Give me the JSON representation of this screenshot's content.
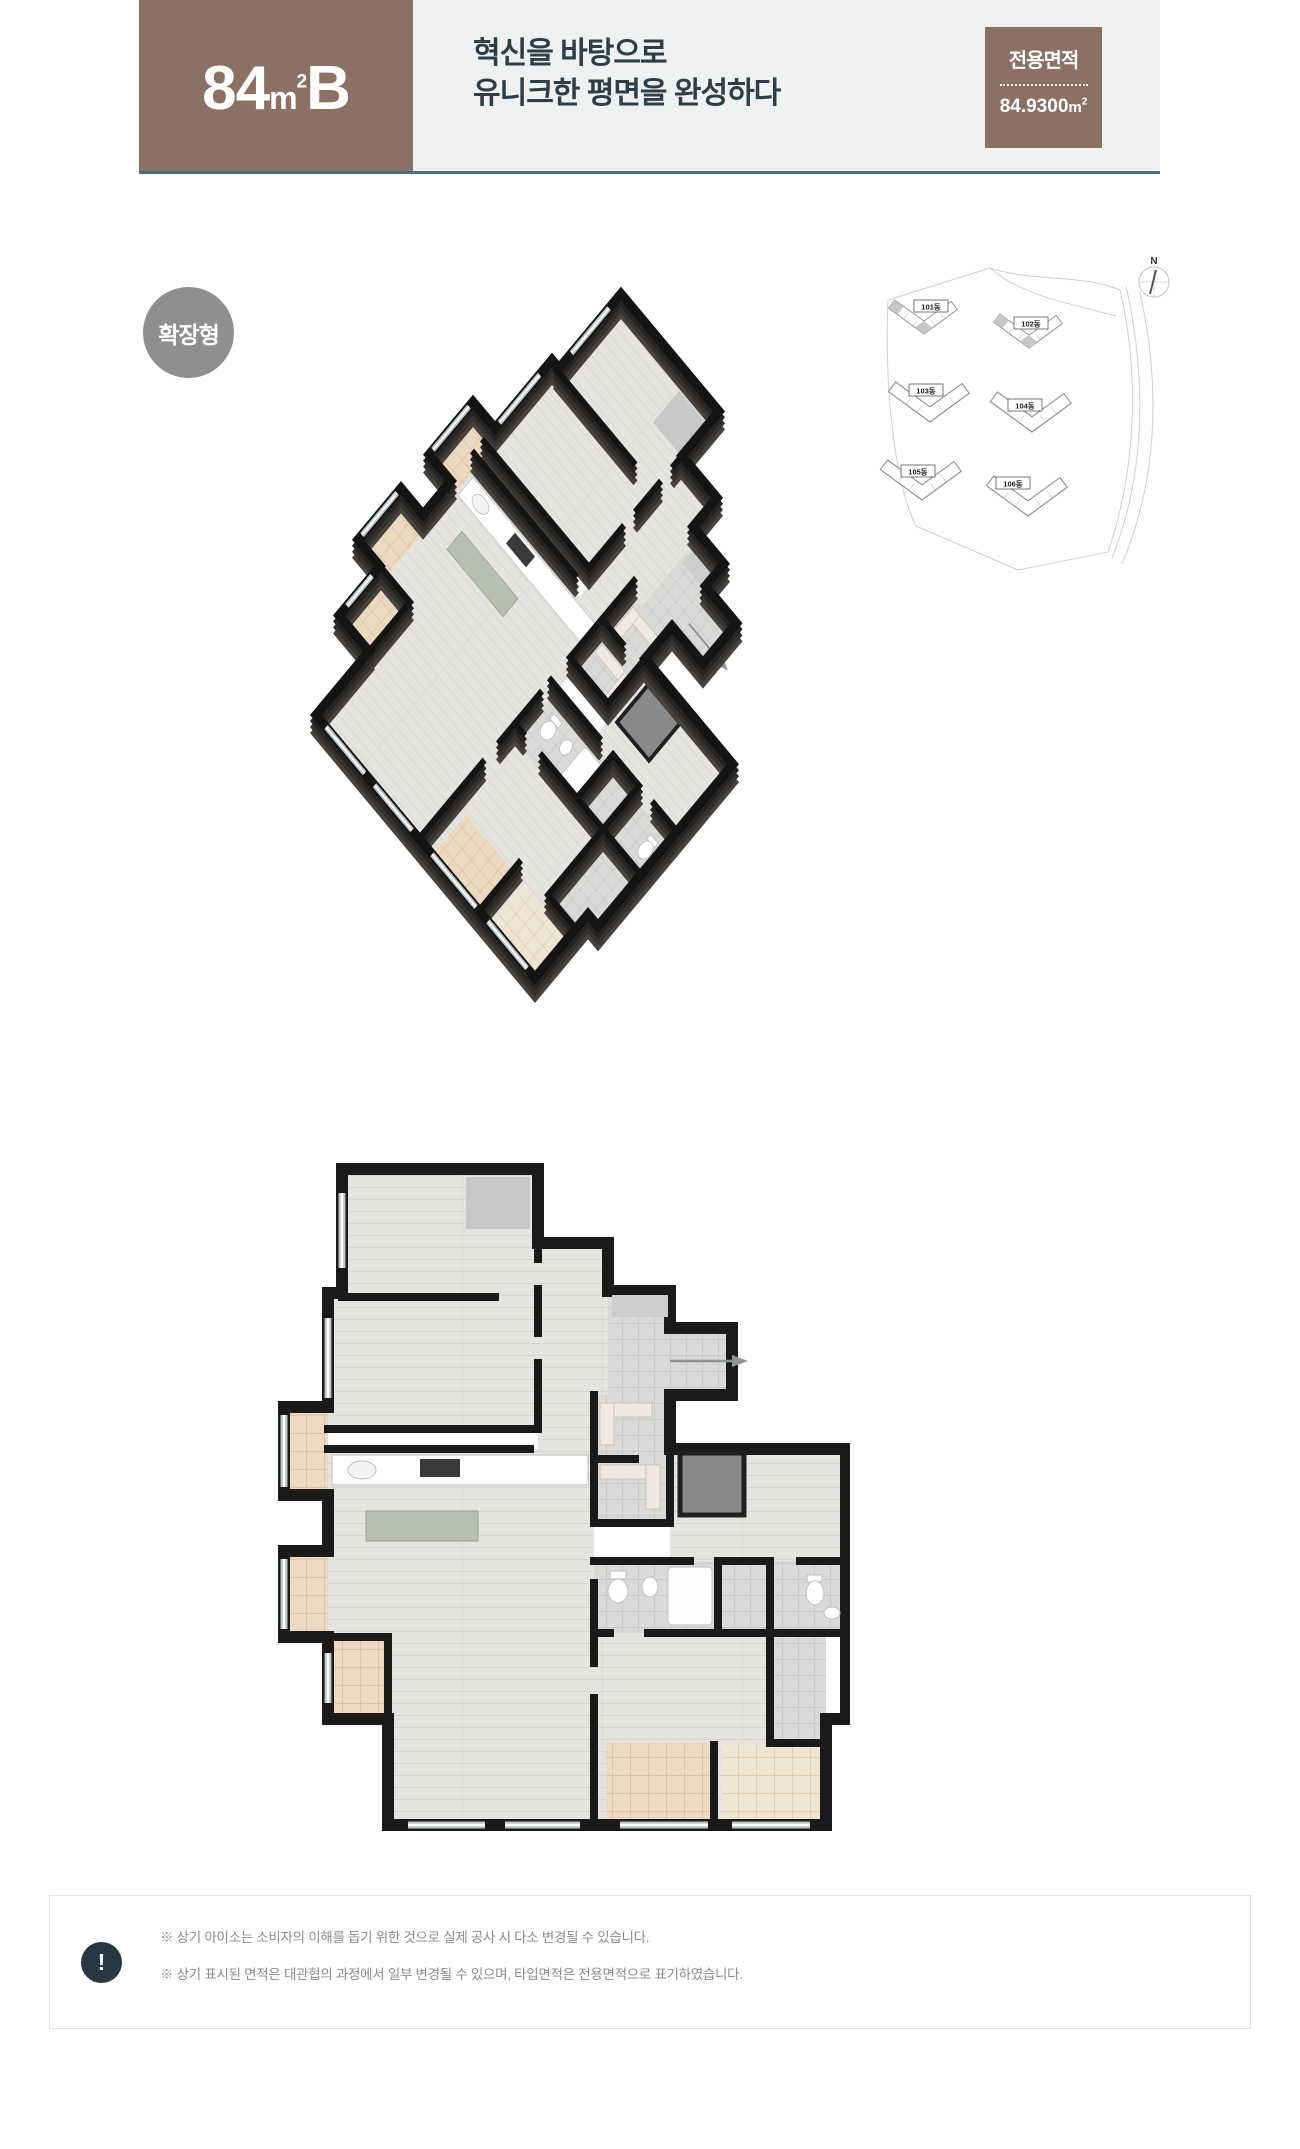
{
  "header": {
    "unit": {
      "num": "84",
      "m": "m",
      "sup": "2",
      "variant": "B"
    },
    "title_line1": "혁신을 바탕으로",
    "title_line2": "유니크한 평면을 완성하다",
    "area_box": {
      "label": "전용면적",
      "value": "84.9300",
      "unit_m": "m",
      "unit_sup": "2"
    },
    "colors": {
      "brown": "#8a7164",
      "band_bg": "#f0f1f1",
      "title_text": "#2d3e49",
      "underline": "#4a6d80"
    }
  },
  "badge": {
    "label": "확장형",
    "color": "#8f8f90"
  },
  "site_plan": {
    "compass_label": "N",
    "buildings": [
      {
        "name": "101동",
        "highlighted": true
      },
      {
        "name": "102동",
        "highlighted": true
      },
      {
        "name": "103동",
        "highlighted": false
      },
      {
        "name": "104동",
        "highlighted": false
      },
      {
        "name": "105동",
        "highlighted": false
      },
      {
        "name": "106동",
        "highlighted": false
      }
    ]
  },
  "floor_plan": {
    "type_shown": "3D isometric view (top) and 2D top view (bottom) of unit 84B",
    "colors": {
      "wall": "#1a1a1a",
      "wood_floor": "#e5e4e0",
      "balcony_tile": "#ecd9c1",
      "bath_tile": "#dadbd9"
    }
  },
  "footer": {
    "icon_label": "!",
    "notes": [
      "※ 상기 아이소는 소비자의 이해를 돕기 위한 것으로 실제 공사 시 다소 변경될 수 있습니다.",
      "※ 상기 표시된 면적은 대관협의 과정에서 일부 변경될 수 있으며, 타입면적은 전용면적으로 표기하였습니다."
    ]
  }
}
